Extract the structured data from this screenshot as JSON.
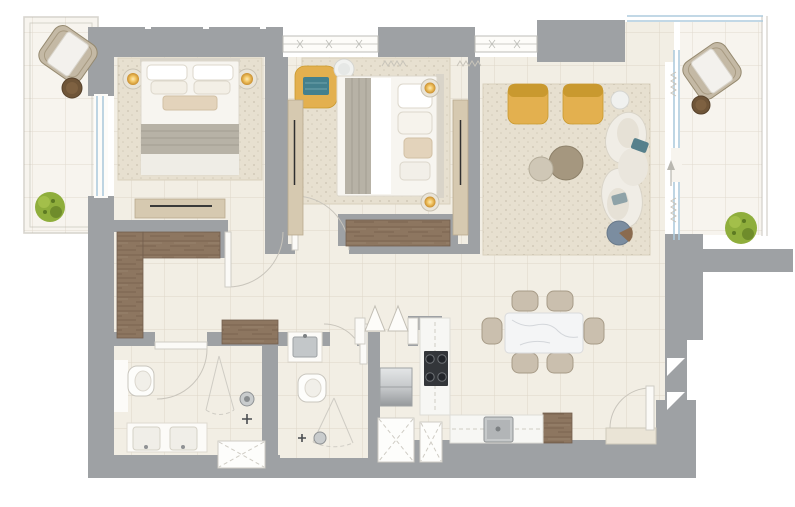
{
  "scene": {
    "kind": "apartment-floor-plan",
    "style": "top-down furnished architectural rendering",
    "visible_text": "none",
    "rooms": [
      {
        "id": "balcony-left",
        "furniture": [
          "woven-lounge-chair",
          "round-side-table",
          "potted-plant"
        ]
      },
      {
        "id": "bedroom-1",
        "furniture": [
          "double-bed",
          "rug",
          "bedside-lamp-left",
          "bedside-lamp-right",
          "dresser"
        ]
      },
      {
        "id": "bedroom-2",
        "furniture": [
          "double-bed",
          "rug",
          "yellow-corner-chair",
          "teal-throw",
          "round-side-table",
          "bedside-lamp-top",
          "bedside-lamp-bottom",
          "wardrobe-left",
          "wardrobe-right",
          "media-console"
        ]
      },
      {
        "id": "living-room",
        "furniture": [
          "rug",
          "yellow-armchair-1",
          "yellow-armchair-2",
          "round-side-table",
          "coffee-table-large",
          "coffee-table-small",
          "curved-sofa",
          "teal-pillows",
          "round-pouf"
        ]
      },
      {
        "id": "dining-area",
        "furniture": [
          "marble-dining-table",
          "dining-chairs-x6"
        ]
      },
      {
        "id": "kitchen",
        "furniture": [
          "fridge",
          "cooktop-4-burner",
          "counter-run-vertical",
          "counter-run-horizontal",
          "stainless-sink",
          "wood-cabinet",
          "service-shafts"
        ]
      },
      {
        "id": "master-bathroom",
        "furniture": [
          "toilet",
          "walk-in-shower",
          "double-vanity-sinks",
          "service-shaft"
        ]
      },
      {
        "id": "bathroom-2",
        "furniture": [
          "washbasin",
          "toilet",
          "walk-in-shower"
        ]
      },
      {
        "id": "hallway",
        "furniture": [
          "l-shaped-closet",
          "console-table"
        ]
      },
      {
        "id": "terrace-right",
        "furniture": [
          "woven-lounge-chair",
          "round-side-table",
          "potted-plant"
        ]
      }
    ],
    "doors": [
      "bedroom-1-door",
      "bedroom-2-door",
      "master-bath-door",
      "bathroom-2-door",
      "kitchen-double-door",
      "entry-door",
      "terrace-sliding-door"
    ],
    "windows": [
      "top-window-1",
      "top-window-2",
      "left-balcony-window",
      "living-terrace-glass-wall"
    ]
  },
  "colors": {
    "wall": "#9EA1A4",
    "floor_indoor": "#F2EEE4",
    "floor_outdoor": "#F7F4EE",
    "grid_line": "#D9D2C0",
    "rug": "#E7E0D0",
    "rug_border": "#D8D0BD",
    "wood": "#8D7660",
    "wood_dark": "#74604E",
    "cabinet_beige": "#D6C9B0",
    "cabinet_beige_dark": "#B9AB8F",
    "accent_yellow": "#E3B04F",
    "accent_yellow_dark": "#C9992F",
    "accent_teal": "#44808D",
    "pillow_teal": "#56808C",
    "pillow_gray": "#8FA3A8",
    "glass_blue": "#AECBDD",
    "furniture_white": "#FBFAF7",
    "furniture_cream": "#EFECE4",
    "blanket_gray": "#B7B2A6",
    "marble": "#F4F5F6",
    "marble_vein": "#D3D6DA",
    "steel_light": "#D9DBDC",
    "steel_dark": "#8F9294",
    "cooktop_black": "#33363A",
    "table_brown": "#6F5538",
    "coffee_table_taupe": "#A5977F",
    "coffee_table_light": "#CFC7B6",
    "chair_taupe": "#CABFAE",
    "chair_taupe_dark": "#A79B87",
    "plant_green": "#8FAE3C",
    "plant_green_dark": "#6F8C2B",
    "lamp_glow": "#E8A93C",
    "pouf_blue": "#7B8DA0",
    "line_light": "#CFCCC4",
    "door_arc": "#C9C5BC",
    "curtain": "#C8C4BA",
    "threshold": "#EAE4D6",
    "rail_gray": "#D8D5CF"
  }
}
